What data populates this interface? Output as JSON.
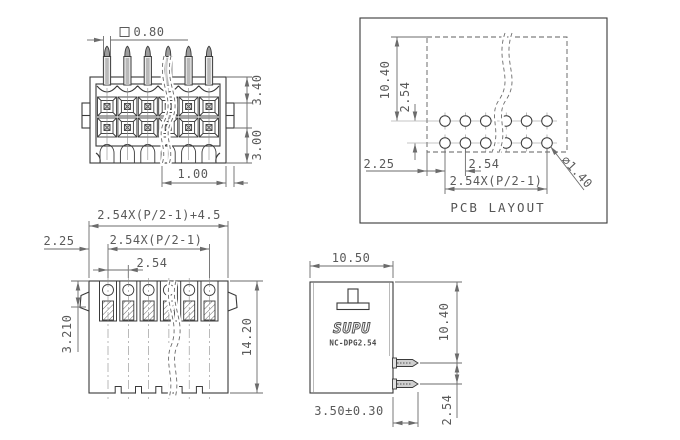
{
  "views": {
    "front": {
      "dim_pin_square": "0.80",
      "dim_upper_height": "3.40",
      "dim_lower_height": "3.00",
      "dim_edge": "1.00"
    },
    "pcb_layout": {
      "title": "PCB LAYOUT",
      "dim_height": "10.40",
      "dim_row_pitch": "2.54",
      "dim_edge_offset": "2.25",
      "dim_col_pitch": "2.54",
      "dim_col_span": "2.54X(P/2-1)",
      "dim_hole_dia": "⌀1.40"
    },
    "top": {
      "dim_total_width": "2.54X(P/2-1)+4.5",
      "dim_span": "2.54X(P/2-1)",
      "dim_pitch": "2.54",
      "dim_edge_offset": "2.25",
      "dim_contact_depth": "3.210",
      "dim_body_depth": "14.20"
    },
    "side": {
      "brand": "SUPU",
      "model": "NC-DPG2.54",
      "dim_width": "10.50",
      "dim_height": "10.40",
      "dim_pin_pitch": "2.54",
      "dim_pin_length": "3.50±0.30"
    }
  },
  "colors": {
    "object_line": "#3a3a3a",
    "dimension": "#6b6b6b"
  }
}
